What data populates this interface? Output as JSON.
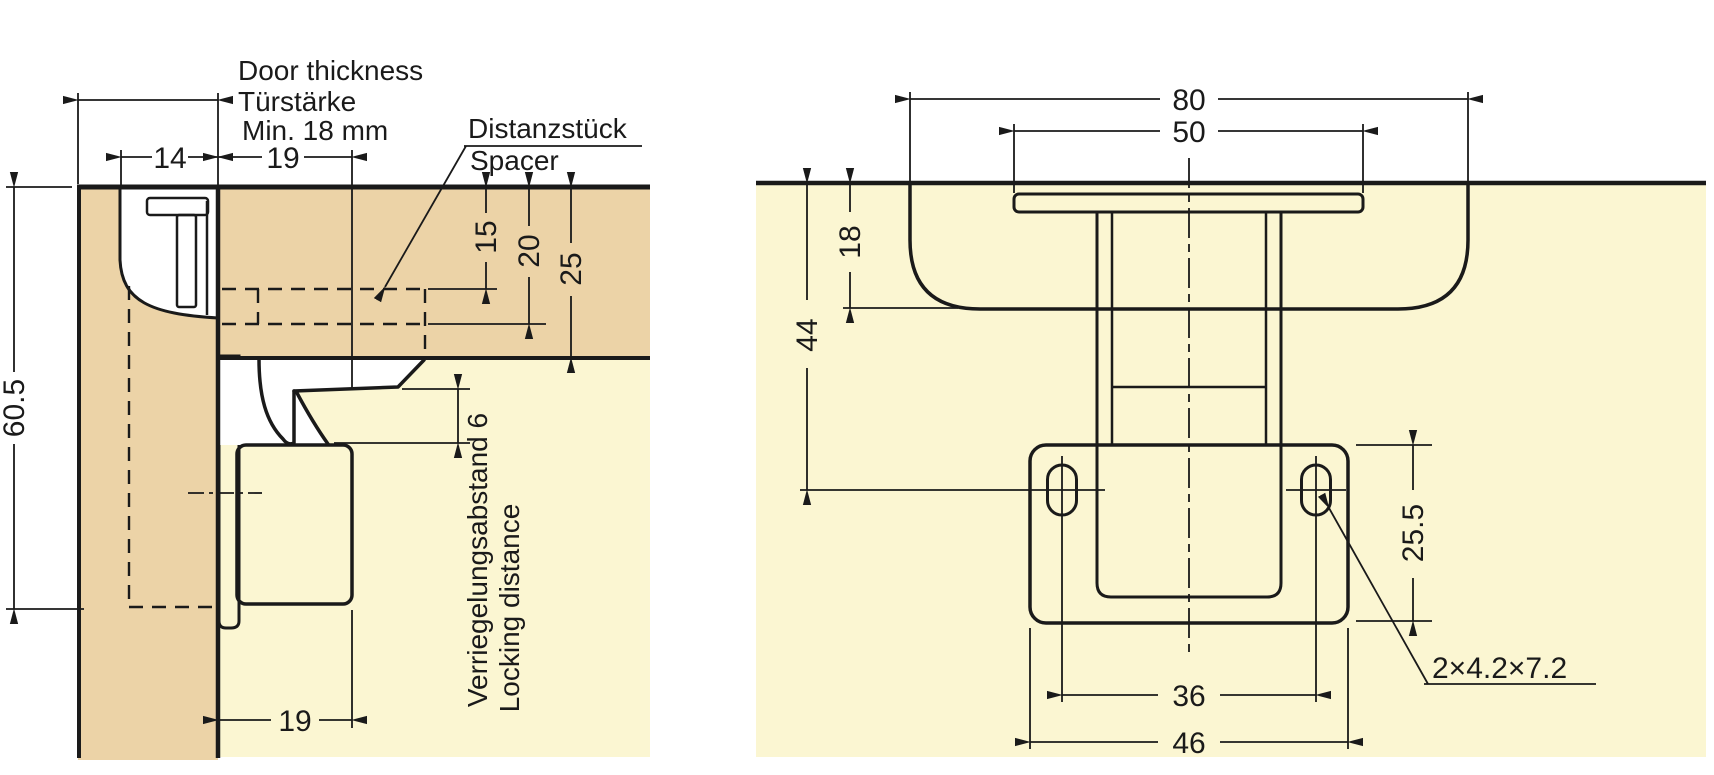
{
  "drawing": {
    "type": "technical-installation-diagram",
    "colors": {
      "background": "#ffffff",
      "wood_panel": "#ecd3a7",
      "cabinet_interior": "#fbf6d2",
      "line": "#1a1a1a",
      "part_fill": "#ffffff"
    },
    "left": {
      "door_thickness_line1": "Door thickness",
      "door_thickness_line2": "Türstärke",
      "door_thickness_line3": "Min. 18 mm",
      "spacer_label_de": "Distanzstück",
      "spacer_label_en": "Spacer",
      "dim_side_overlay": "14",
      "dim_latch_depth_top": "19",
      "dim_spacer_top_offset": "15",
      "dim_spacer_bottom_offset": "20",
      "dim_panel_thickness": "25",
      "dim_overall_height": "60.5",
      "dim_latch_depth_bottom": "19",
      "locking_label_de": "Verriegelungsabstand 6",
      "locking_label_en": "Locking distance"
    },
    "right": {
      "dim_catch_width": "80",
      "dim_flange_width": "50",
      "dim_catch_height": "18",
      "dim_hole_center_depth": "44",
      "dim_plate_height": "25.5",
      "dim_hole_spacing": "36",
      "dim_plate_width": "46",
      "slot_note": "2×4.2×7.2"
    }
  }
}
